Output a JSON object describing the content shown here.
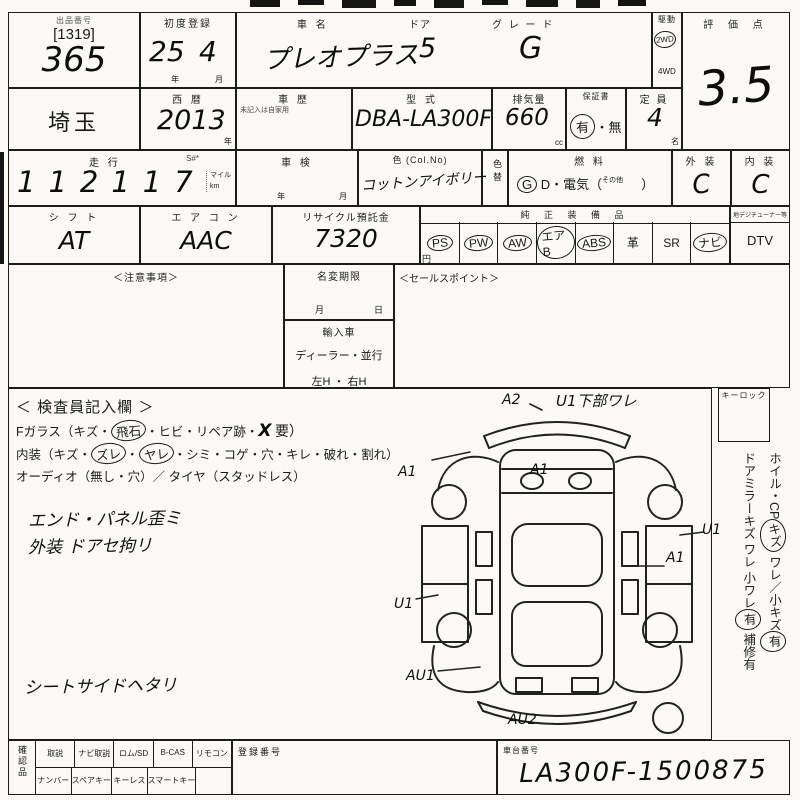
{
  "sheet": {
    "lot": {
      "label": "出品番号",
      "bracket": "[1319]",
      "number": "365"
    },
    "first_registration": {
      "label": "初度登録",
      "year": "25",
      "month": "4",
      "year_unit": "年",
      "month_unit": "月"
    },
    "car": {
      "name_label": "車  名",
      "name": "プレオプラス",
      "door_label": "ドア",
      "door": "5",
      "grade_label": "グ レ ー ド",
      "grade": "G"
    },
    "drive": {
      "label": "駆動",
      "opt1": "2WD",
      "opt2": "4WD"
    },
    "score": {
      "label": "評 価 点",
      "value": "3.5"
    },
    "region": "埼玉",
    "year": {
      "label": "西 暦",
      "value": "2013",
      "unit": "年"
    },
    "history": {
      "label": "車 歴",
      "note": "未記入は自家用"
    },
    "model": {
      "label": "型 式",
      "value": "DBA-LA300F"
    },
    "displacement": {
      "label": "排気量",
      "value": "660",
      "unit": "cc"
    },
    "warranty": {
      "label": "保証書",
      "yes": "有",
      "sep": "・",
      "no": "無"
    },
    "capacity": {
      "label": "定 員",
      "value": "4",
      "unit": "名"
    },
    "mileage": {
      "label": "走 行",
      "s_label": "S#*",
      "value": "112117",
      "unit1": "マイル",
      "unit2": "km"
    },
    "shaken": {
      "label": "車 検",
      "year_unit": "年",
      "month_unit": "月"
    },
    "color": {
      "label": "色 (Col.No)",
      "value": "コットンアイボリー",
      "change_label": "色替"
    },
    "fuel": {
      "label": "燃  料",
      "g": "G",
      "rest1": "D・電気（",
      "other": "その他",
      "rest2": "）"
    },
    "exterior": {
      "label": "外 装",
      "value": "C"
    },
    "interior": {
      "label": "内 装",
      "value": "C"
    },
    "shift": {
      "label": "シ フ ト",
      "value": "AT"
    },
    "aircon": {
      "label": "エ ア コ ン",
      "value": "AAC"
    },
    "recycle": {
      "label": "リサイクル預託金",
      "value": "7320",
      "unit": "円"
    },
    "equipment": {
      "label": "純 正 装 備 品",
      "items": [
        {
          "label": "PS",
          "circled": true
        },
        {
          "label": "PW",
          "circled": true
        },
        {
          "label": "AW",
          "circled": true
        },
        {
          "label": "エアB",
          "circled": true
        },
        {
          "label": "ABS",
          "circled": true
        },
        {
          "label": "革",
          "circled": false
        },
        {
          "label": "SR",
          "circled": false
        },
        {
          "label": "ナビ",
          "circled": true
        }
      ],
      "dtv_header": "地デジチューナー等",
      "dtv": {
        "label": "DTV",
        "circled": false
      }
    },
    "notes_box": {
      "label": "＜注意事項＞"
    },
    "name_change": {
      "label": "名変期限",
      "month": "月",
      "day": "日"
    },
    "import": {
      "label": "輸入車",
      "type": "ディーラー・並行",
      "handle": "左H ・ 右H"
    },
    "sales_point": {
      "label": "＜セールスポイント＞"
    },
    "inspector": {
      "title": "＜ 検査員記入欄 ＞",
      "fglass": {
        "p1": "Fガラス（キズ・",
        "c1": "飛石",
        "p2": "・ヒビ・リペア跡・",
        "x": "X",
        "p3": "要）"
      },
      "interior_line": {
        "p1": "内装（キズ・",
        "c1": "ズレ",
        "p2": "・",
        "c2": "ヤレ",
        "p3": "・シミ・コゲ・穴・キレ・破れ・割れ）"
      },
      "audio_line": "オーディオ（無し・穴）／ タイヤ（スタッドレス）",
      "handnotes": [
        "エンド・パネル歪ミ",
        "外装 ドアセ拘リ",
        "シートサイドヘタリ"
      ]
    },
    "keylock": {
      "label": "キーロック"
    },
    "side_note": {
      "p1": "ホイル・CP",
      "c1": "キズ",
      "p2": " ワレ／小キズ",
      "c2": "有",
      "p3": "ドアミラーキズ ワレ 小ワレ",
      "c3": "有",
      "p4": " 補修有"
    },
    "diagram": {
      "annotations": {
        "a2": "A2",
        "u1_crack": "U1下部ワレ",
        "a1_left": "A1",
        "a1_hood": "A1",
        "u1_right": "U1",
        "a1_right": "A1",
        "u1_left": "U1",
        "au1": "AU1",
        "au2": "AU2"
      }
    },
    "bottom": {
      "confirm_label": "確認品",
      "row1": [
        "取説",
        "ナビ取説",
        "ロム/SD",
        "B-CAS",
        "リモコン"
      ],
      "row2": [
        "ナンバー",
        "スペアキー",
        "キーレス",
        "スマートキー",
        ""
      ],
      "reg_label": "登録番号",
      "chassis_label": "車台番号",
      "chassis": "LA300F-1500875"
    }
  }
}
